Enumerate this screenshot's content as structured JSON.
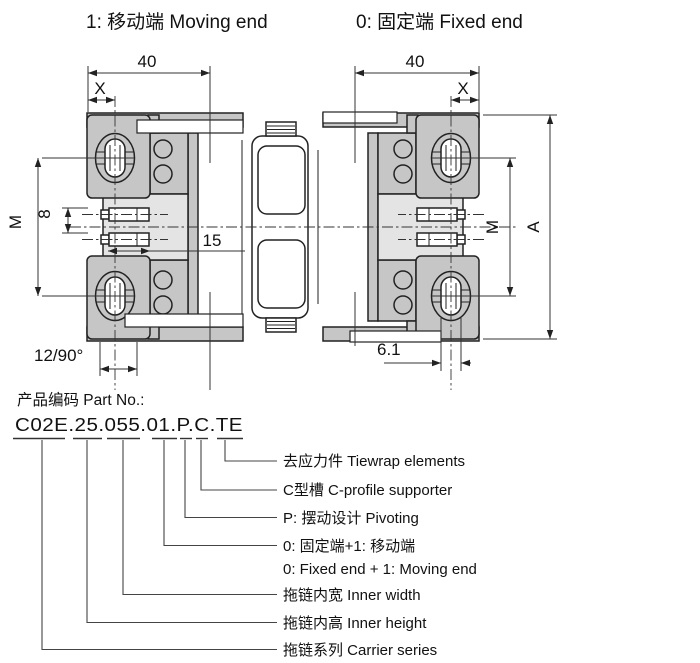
{
  "header": {
    "moving_end": "1: 移动端 Moving end",
    "fixed_end": "0: 固定端 Fixed end"
  },
  "dims": {
    "forty_left": "40",
    "forty_right": "40",
    "x_left": "X",
    "x_right": "X",
    "m_left": "M",
    "m_right": "M",
    "eight": "8",
    "fifteen": "15",
    "twelve_ninety": "12/90°",
    "six_one": "6.1",
    "a_height": "A"
  },
  "part": {
    "heading": "产品编码 Part No.:",
    "code": "C02E.25.055.01.P.C.TE",
    "callouts": [
      {
        "label": "去应力件 Tiewrap elements"
      },
      {
        "label": "C型槽 C-profile supporter"
      },
      {
        "label": "P: 摆动设计 Pivoting"
      },
      {
        "label": "0: 固定端+1: 移动端",
        "label2": "0: Fixed end + 1: Moving end"
      },
      {
        "label": "拖链内宽 Inner width"
      },
      {
        "label": "拖链内高 Inner height"
      },
      {
        "label": "拖链系列 Carrier series"
      }
    ]
  }
}
